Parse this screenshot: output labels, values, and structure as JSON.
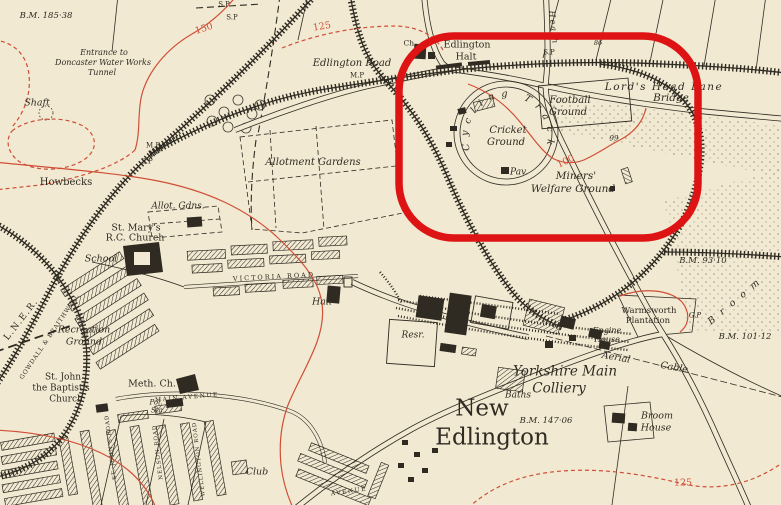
{
  "map": {
    "background_color": "#f2e9d2",
    "ink_color": "#2f2b22",
    "contour_color": "#cf4f36",
    "curved": {
      "cycling_track": "Cycling Track"
    },
    "labels": [
      {
        "id": "bm-185-38",
        "text": "B.M. 185·38",
        "x": 46,
        "y": 16,
        "fs": 8.5,
        "italic": true
      },
      {
        "id": "entrance-1",
        "text": "Entrance to",
        "x": 104,
        "y": 53,
        "fs": 8,
        "italic": true
      },
      {
        "id": "entrance-2",
        "text": "Doncaster Water Works",
        "x": 103,
        "y": 63,
        "fs": 8,
        "italic": true
      },
      {
        "id": "entrance-3",
        "text": "Tunnel",
        "x": 102,
        "y": 73,
        "fs": 8,
        "italic": true
      },
      {
        "id": "shaft",
        "text": "Shaft",
        "x": 37,
        "y": 103,
        "fs": 9.5,
        "italic": true
      },
      {
        "id": "sp-1",
        "text": "S.P",
        "x": 224,
        "y": 5,
        "fs": 7
      },
      {
        "id": "sp-2",
        "text": "S.P",
        "x": 232,
        "y": 18,
        "fs": 7
      },
      {
        "id": "contour-150",
        "text": "150",
        "x": 204,
        "y": 29,
        "fs": 9.5,
        "rot": -18,
        "color": "contour"
      },
      {
        "id": "contour-125-top",
        "text": "125",
        "x": 322,
        "y": 27,
        "fs": 9.5,
        "rot": -10,
        "color": "contour"
      },
      {
        "id": "edlington-road",
        "text": "Edlington Road",
        "x": 352,
        "y": 64,
        "fs": 10,
        "italic": true
      },
      {
        "id": "mp-1",
        "text": "M.P",
        "x": 357,
        "y": 76,
        "fs": 7
      },
      {
        "id": "ch",
        "text": "Ch.",
        "x": 410,
        "y": 43,
        "fs": 7.5
      },
      {
        "id": "edlington-halt-1",
        "text": "Edlington",
        "x": 467,
        "y": 45,
        "fs": 9.5
      },
      {
        "id": "edlington-halt-2",
        "text": "Halt",
        "x": 466,
        "y": 57,
        "fs": 9.5
      },
      {
        "id": "sp-3",
        "text": "S.P",
        "x": 549,
        "y": 53,
        "fs": 7
      },
      {
        "id": "spot-86",
        "text": "86",
        "x": 598,
        "y": 43,
        "fs": 6.5,
        "italic": true
      },
      {
        "id": "heath-lane",
        "text": "Heath",
        "x": 553,
        "y": 28,
        "fs": 8,
        "italic": true,
        "rot": 84,
        "ls": 2
      },
      {
        "id": "lords-head-lane",
        "text": "Lord's Head Lane",
        "x": 664,
        "y": 87,
        "fs": 10.5,
        "italic": true,
        "ls": 1.5
      },
      {
        "id": "lords-head-bridge",
        "text": "Bridge",
        "x": 671,
        "y": 98,
        "fs": 10.5,
        "italic": true
      },
      {
        "id": "cricket-1",
        "text": "Cricket",
        "x": 508,
        "y": 131,
        "fs": 10,
        "italic": true
      },
      {
        "id": "cricket-2",
        "text": "Ground",
        "x": 506,
        "y": 143,
        "fs": 10,
        "italic": true
      },
      {
        "id": "football-1",
        "text": "Football",
        "x": 570,
        "y": 101,
        "fs": 10,
        "italic": true
      },
      {
        "id": "football-2",
        "text": "Ground",
        "x": 568,
        "y": 113,
        "fs": 10,
        "italic": true
      },
      {
        "id": "spot-99",
        "text": "99",
        "x": 614,
        "y": 139,
        "fs": 7,
        "italic": true
      },
      {
        "id": "contour-100",
        "text": "100",
        "x": 566,
        "y": 162,
        "fs": 9.5,
        "rot": -25,
        "color": "contour"
      },
      {
        "id": "pavilion",
        "text": "Pav.",
        "x": 519,
        "y": 173,
        "fs": 9,
        "italic": true
      },
      {
        "id": "miners-1",
        "text": "Miners'",
        "x": 576,
        "y": 176,
        "fs": 10.5,
        "italic": true
      },
      {
        "id": "miners-2",
        "text": "Welfare Ground",
        "x": 573,
        "y": 189,
        "fs": 10.5,
        "italic": true
      },
      {
        "id": "allotment-gardens",
        "text": "Allotment Gardens",
        "x": 313,
        "y": 163,
        "fs": 10,
        "italic": true
      },
      {
        "id": "mp-2",
        "text": "M.P",
        "x": 153,
        "y": 146,
        "fs": 7
      },
      {
        "id": "sp-4",
        "text": "S.P",
        "x": 147,
        "y": 162,
        "fs": 7
      },
      {
        "id": "howbecks",
        "text": "Howbecks",
        "x": 66,
        "y": 183,
        "fs": 10
      },
      {
        "id": "allot-gdns",
        "text": "Allot. Gdns.",
        "x": 178,
        "y": 207,
        "fs": 9,
        "italic": true
      },
      {
        "id": "st-marys-1",
        "text": "St. Mary's",
        "x": 136,
        "y": 228,
        "fs": 9.5
      },
      {
        "id": "st-marys-2",
        "text": "R.C. Church",
        "x": 135,
        "y": 238,
        "fs": 9.5
      },
      {
        "id": "school",
        "text": "School",
        "x": 101,
        "y": 259,
        "fs": 9.5,
        "italic": true
      },
      {
        "id": "lner",
        "text": "L.N.E.R.",
        "x": 22,
        "y": 320,
        "fs": 9,
        "rot": -52,
        "ls": 1.5
      },
      {
        "id": "gowdall-braithwell",
        "text": "GOWDALL & BRAITHWELL",
        "x": 50,
        "y": 337,
        "fs": 6,
        "rot": -56,
        "ls": 0.8
      },
      {
        "id": "recreation-1",
        "text": "Recreation",
        "x": 84,
        "y": 330,
        "fs": 9.5,
        "italic": true
      },
      {
        "id": "recreation-2",
        "text": "Ground",
        "x": 84,
        "y": 342,
        "fs": 9.5,
        "italic": true
      },
      {
        "id": "st-johns-1",
        "text": "St. John",
        "x": 63,
        "y": 378,
        "fs": 9
      },
      {
        "id": "st-johns-2",
        "text": "the Baptist's",
        "x": 61,
        "y": 389,
        "fs": 9
      },
      {
        "id": "st-johns-3",
        "text": "Church",
        "x": 66,
        "y": 400,
        "fs": 9
      },
      {
        "id": "meth-ch",
        "text": "Meth. Ch.",
        "x": 152,
        "y": 384,
        "fs": 9.5
      },
      {
        "id": "main-avenue",
        "text": "MAIN AVENUE",
        "x": 187,
        "y": 398,
        "fs": 6,
        "ls": 1.5,
        "rot": -5
      },
      {
        "id": "police-sta-1",
        "text": "Pol.",
        "x": 156,
        "y": 403,
        "fs": 7,
        "italic": true
      },
      {
        "id": "police-sta-2",
        "text": "Sta.",
        "x": 158,
        "y": 411,
        "fs": 7,
        "italic": true
      },
      {
        "id": "st-johns-road",
        "text": "ST. JOHN'S ROAD",
        "x": 112,
        "y": 447,
        "fs": 5.5,
        "rot": -97,
        "ls": 1
      },
      {
        "id": "nelson-road",
        "text": "NELSON ROAD",
        "x": 159,
        "y": 452,
        "fs": 5.5,
        "rot": -97,
        "ls": 1
      },
      {
        "id": "wellington-road",
        "text": "WELLINGTON ROAD",
        "x": 200,
        "y": 459,
        "fs": 5.5,
        "rot": -97,
        "ls": 1
      },
      {
        "id": "victoria-road",
        "text": "VICTORIA ROAD",
        "x": 274,
        "y": 277,
        "fs": 6.5,
        "ls": 2,
        "rot": -3
      },
      {
        "id": "hall",
        "text": "Hall",
        "x": 322,
        "y": 302,
        "fs": 9.5,
        "italic": true
      },
      {
        "id": "club",
        "text": "Club",
        "x": 257,
        "y": 472,
        "fs": 9.5,
        "italic": true
      },
      {
        "id": "avenue",
        "text": "AVENUE",
        "x": 349,
        "y": 492,
        "fs": 6,
        "ls": 1.5,
        "rot": -8
      },
      {
        "id": "reservoir",
        "text": "Resr.",
        "x": 413,
        "y": 336,
        "fs": 9,
        "italic": true
      },
      {
        "id": "yorkshire-main-1",
        "text": "Yorkshire Main",
        "x": 565,
        "y": 372,
        "fs": 13.5,
        "italic": true
      },
      {
        "id": "yorkshire-main-2",
        "text": "Colliery",
        "x": 559,
        "y": 389,
        "fs": 13.5,
        "italic": true
      },
      {
        "id": "baths",
        "text": "Baths",
        "x": 518,
        "y": 396,
        "fs": 9,
        "italic": true
      },
      {
        "id": "engine-house-1",
        "text": "Engine",
        "x": 607,
        "y": 331,
        "fs": 8,
        "italic": true
      },
      {
        "id": "engine-house-2",
        "text": "House",
        "x": 607,
        "y": 340,
        "fs": 8,
        "italic": true
      },
      {
        "id": "warmsworth-1",
        "text": "Warmsworth",
        "x": 649,
        "y": 311,
        "fs": 8.5
      },
      {
        "id": "warmsworth-2",
        "text": "Plantation",
        "x": 648,
        "y": 321,
        "fs": 8.5
      },
      {
        "id": "gp",
        "text": "G.P",
        "x": 695,
        "y": 316,
        "fs": 7,
        "italic": true
      },
      {
        "id": "bm-93-10",
        "text": "B.M. 93·10",
        "x": 703,
        "y": 261,
        "fs": 8.5,
        "italic": true
      },
      {
        "id": "broom-lane",
        "text": "Broom",
        "x": 737,
        "y": 300,
        "fs": 9.5,
        "italic": true,
        "rot": -40,
        "ls": 8
      },
      {
        "id": "bm-101-12",
        "text": "B.M. 101·12",
        "x": 745,
        "y": 337,
        "fs": 8.5,
        "italic": true
      },
      {
        "id": "aerial-cable-1",
        "text": "Aerial",
        "x": 616,
        "y": 358,
        "fs": 9.5,
        "italic": true,
        "rot": 10
      },
      {
        "id": "aerial-cable-2",
        "text": "Cable",
        "x": 674,
        "y": 368,
        "fs": 9.5,
        "italic": true,
        "rot": 10
      },
      {
        "id": "new-edlington-1",
        "text": "New",
        "x": 482,
        "y": 409,
        "fs": 23
      },
      {
        "id": "new-edlington-2",
        "text": "Edlington",
        "x": 492,
        "y": 438,
        "fs": 23
      },
      {
        "id": "bm-147-06",
        "text": "B.M. 147·06",
        "x": 546,
        "y": 421,
        "fs": 8.5,
        "italic": true
      },
      {
        "id": "broom-house-1",
        "text": "Broom",
        "x": 657,
        "y": 416,
        "fs": 9.5,
        "italic": true
      },
      {
        "id": "broom-house-2",
        "text": "House",
        "x": 656,
        "y": 428,
        "fs": 9.5,
        "italic": true
      },
      {
        "id": "contour-125-bottom",
        "text": "125",
        "x": 683,
        "y": 483,
        "fs": 9.5,
        "color": "contour"
      }
    ]
  },
  "annotation": {
    "description": "red oval highlighting Miners' Welfare Ground",
    "x": 399,
    "y": 36,
    "width": 299,
    "height": 202,
    "corner_radius": 55,
    "stroke_width": 7.5,
    "color": "#de1414"
  }
}
